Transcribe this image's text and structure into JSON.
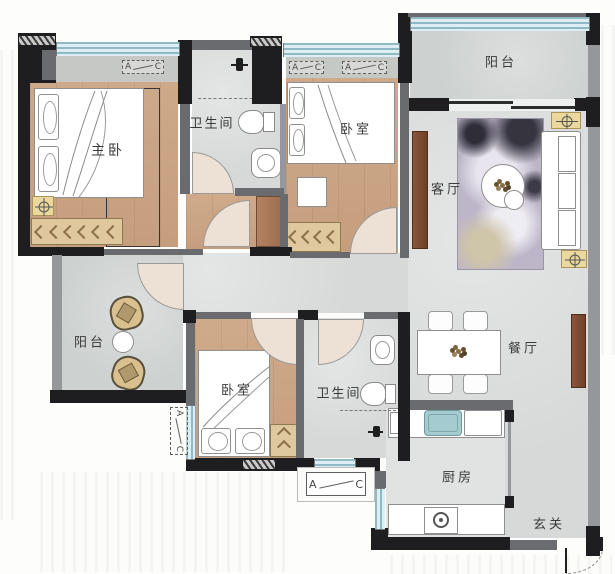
{
  "plan": {
    "type": "apartment-floor-plan",
    "rooms": {
      "master_bedroom": "主卧",
      "bathroom_top": "卫生间",
      "bedroom_top": "卧室",
      "balcony_top": "阳台",
      "living_room": "客厅",
      "dining_room": "餐厅",
      "balcony_left": "阳台",
      "bedroom_bottom": "卧室",
      "bathroom_bottom": "卫生间",
      "kitchen": "厨房",
      "foyer": "玄关"
    },
    "ac_mark": {
      "a": "A",
      "c": "C"
    },
    "colors": {
      "wall": "#1e1e20",
      "wall_gray": "#6a6b6f",
      "floor_wood": "#c9a484",
      "floor_tile": "#d6d9d8",
      "window_glass": "#a9cbd4",
      "cabinet_tan": "#e0c89e",
      "sofa_white": "#ffffff",
      "sink_teal": "#a3cbd0",
      "furniture_brown": "#7b4a32",
      "accent_yellow": "#ead89f"
    }
  }
}
